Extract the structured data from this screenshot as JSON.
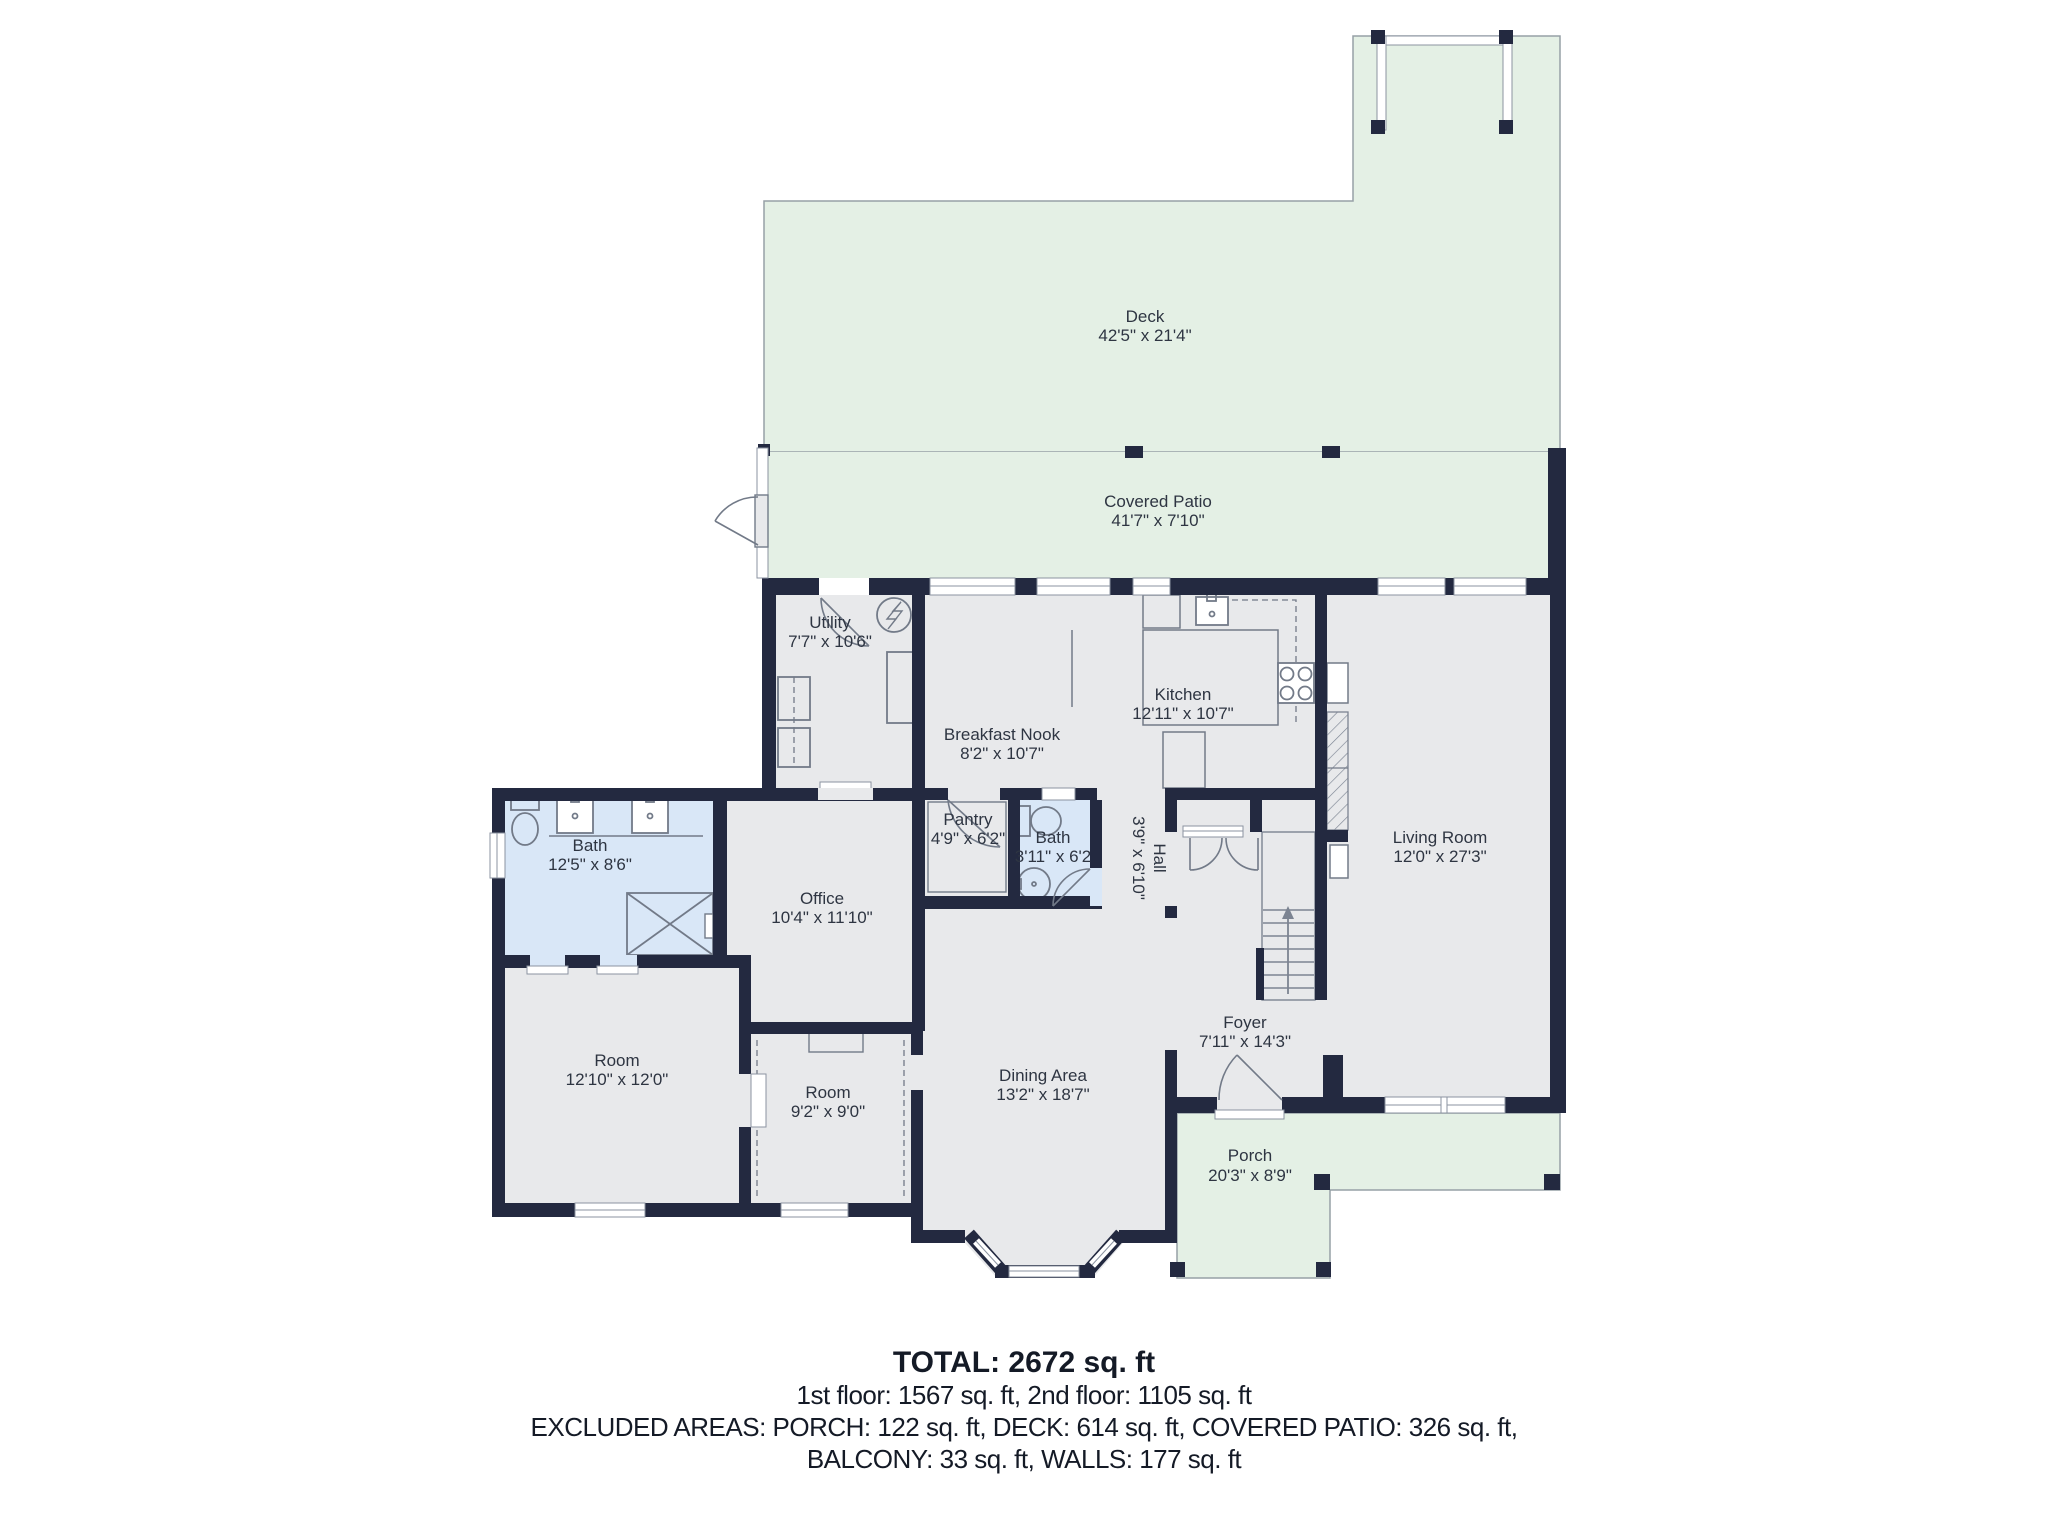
{
  "plan_type": "floor-plan",
  "rooms": {
    "deck": {
      "name": "Deck",
      "dims": "42'5\" x 21'4\""
    },
    "covered_patio": {
      "name": "Covered Patio",
      "dims": "41'7\" x 7'10\""
    },
    "utility": {
      "name": "Utility",
      "dims": "7'7\" x 10'6\""
    },
    "kitchen": {
      "name": "Kitchen",
      "dims": "12'11\" x 10'7\""
    },
    "breakfast_nook": {
      "name": "Breakfast Nook",
      "dims": "8'2\" x 10'7\""
    },
    "bath_main": {
      "name": "Bath",
      "dims": "12'5\" x 8'6\""
    },
    "pantry": {
      "name": "Pantry",
      "dims": "4'9\" x 6'2\""
    },
    "bath_small": {
      "name": "Bath",
      "dims": "3'11\" x 6'2"
    },
    "hall": {
      "name": "Hall",
      "dims": "3'9\" x 6'10\""
    },
    "living_room": {
      "name": "Living Room",
      "dims": "12'0\" x 27'3\""
    },
    "office": {
      "name": "Office",
      "dims": "10'4\" x 11'10\""
    },
    "room_large": {
      "name": "Room",
      "dims": "12'10\" x 12'0\""
    },
    "room_small": {
      "name": "Room",
      "dims": "9'2\" x 9'0\""
    },
    "dining_area": {
      "name": "Dining Area",
      "dims": "13'2\" x 18'7\""
    },
    "foyer": {
      "name": "Foyer",
      "dims": "7'11\" x 14'3\""
    },
    "porch": {
      "name": "Porch",
      "dims": "20'3\" x 8'9\""
    }
  },
  "summary": {
    "total": "TOTAL: 2672 sq. ft",
    "floors": "1st floor: 1567 sq. ft, 2nd floor: 1105 sq. ft",
    "excluded1": "EXCLUDED AREAS: PORCH: 122 sq. ft, DECK: 614 sq. ft, COVERED PATIO: 326 sq. ft,",
    "excluded2": "BALCONY: 33 sq. ft, WALLS: 177 sq. ft"
  },
  "icons": {
    "electrical-panel-icon": "circle with lightning bolt",
    "stair-direction-arrow": "up arrow",
    "shower-icon": "rectangle with X",
    "stove-icon": "four burner circles",
    "door-swing": "quarter-circle arc"
  },
  "colors": {
    "wall": "#232940",
    "floor": "#e8e9eb",
    "outdoor_green": "#e4f0e5",
    "bath_blue": "#d9e7f7",
    "outline_gray": "#96a0a6",
    "fixture_gray": "#727a88",
    "window_frame": "#8b93a0",
    "label_text": "#2e3542",
    "summary_text": "#141a26"
  }
}
